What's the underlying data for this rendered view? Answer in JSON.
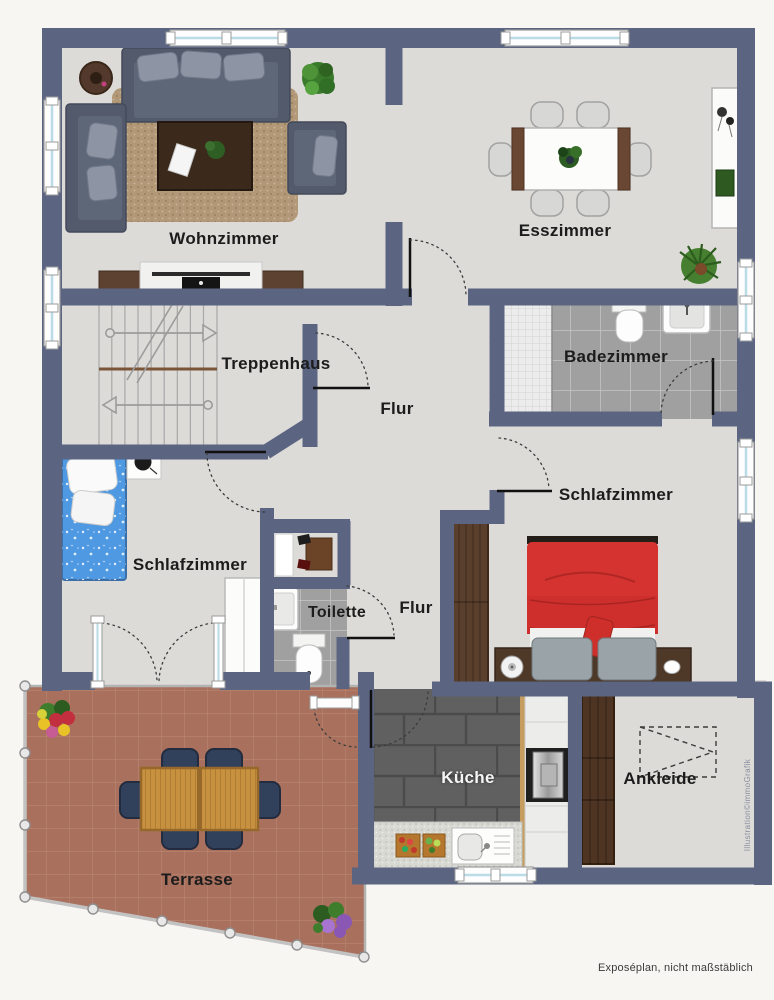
{
  "plan": {
    "rooms": {
      "wohnzimmer": "Wohnzimmer",
      "esszimmer": "Esszimmer",
      "treppenhaus": "Treppenhaus",
      "flur_oben": "Flur",
      "badezimmer": "Badezimmer",
      "schlafzimmer_rechts": "Schlafzimmer",
      "schlafzimmer_links": "Schlafzimmer",
      "toilette": "Toilette",
      "flur_unten": "Flur",
      "kueche": "Küche",
      "ankleide": "Ankleide",
      "terrasse": "Terrasse"
    },
    "footer": {
      "disclaimer": "Exposéplan, nicht maßstäblich"
    },
    "credit": "Illustration©immoGrafik",
    "colors": {
      "wall": "#5b6480",
      "floor": "#dcdbd7",
      "terrace_tile": "#a8705d",
      "bath_tile": "#a0a0a0",
      "kitchen_tile": "#606060",
      "bed_red": "#d43330",
      "bed_blue": "#4f99e2"
    }
  }
}
